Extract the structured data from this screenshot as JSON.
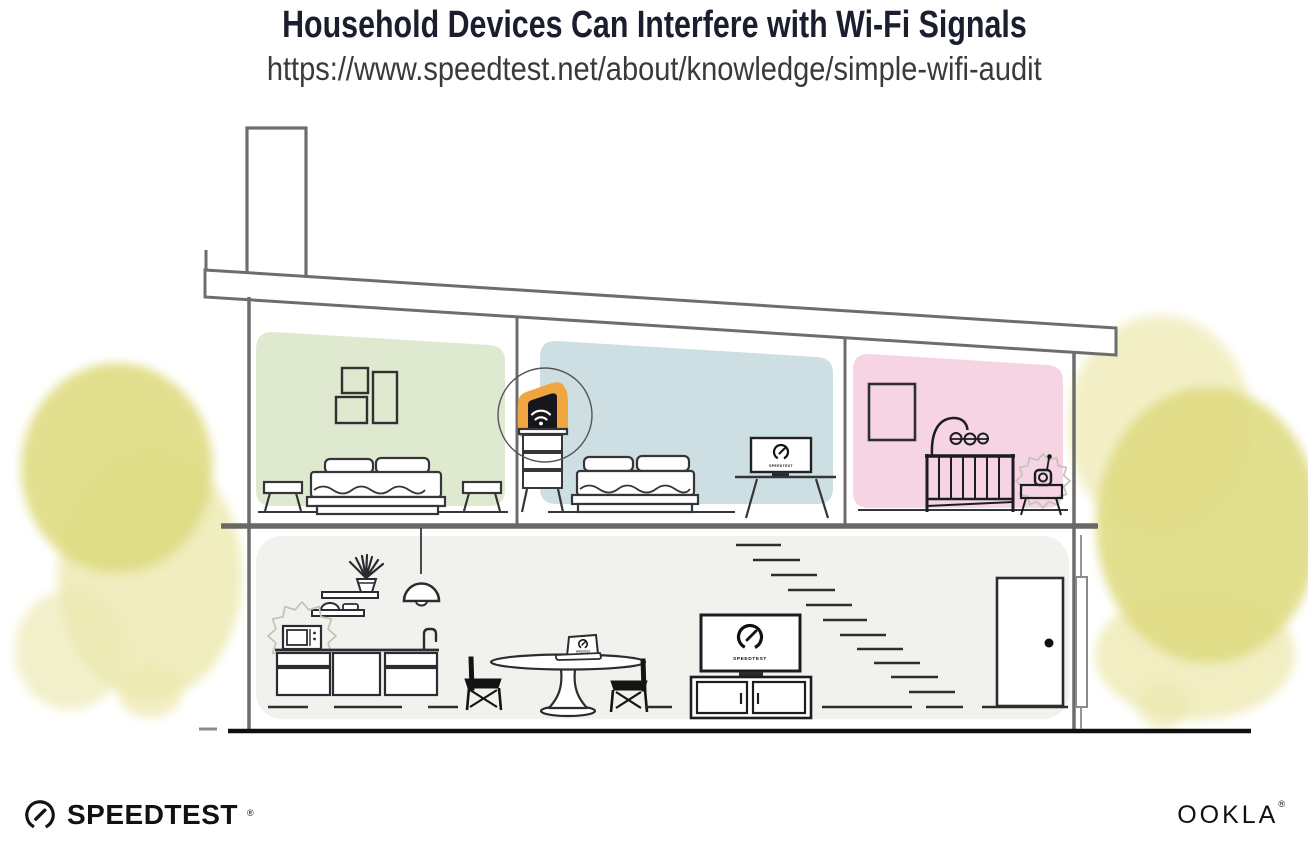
{
  "header": {
    "title": "Household Devices Can Interfere with Wi-Fi Signals",
    "url": "https://www.speedtest.net/about/knowledge/simple-wifi-audit"
  },
  "illustration": {
    "tv_screen_label": "SPEEDTEST",
    "monitor_screen_label": "SPEEDTEST",
    "laptop_screen_label": "SPEEDTEST",
    "colors": {
      "green_room": "#dfe9d0",
      "blue_room": "#cddfe2",
      "pink_room": "#f6d4e4",
      "ground_floor": "#f1f1ee",
      "router_highlight": "#f0a640",
      "bush_main": "#dfdc82",
      "bush_light": "#edeab3"
    }
  },
  "footer": {
    "speedtest_wordmark": "SPEEDTEST",
    "speedtest_mark": "®",
    "ookla_wordmark": "OOKLA",
    "ookla_mark": "®"
  }
}
